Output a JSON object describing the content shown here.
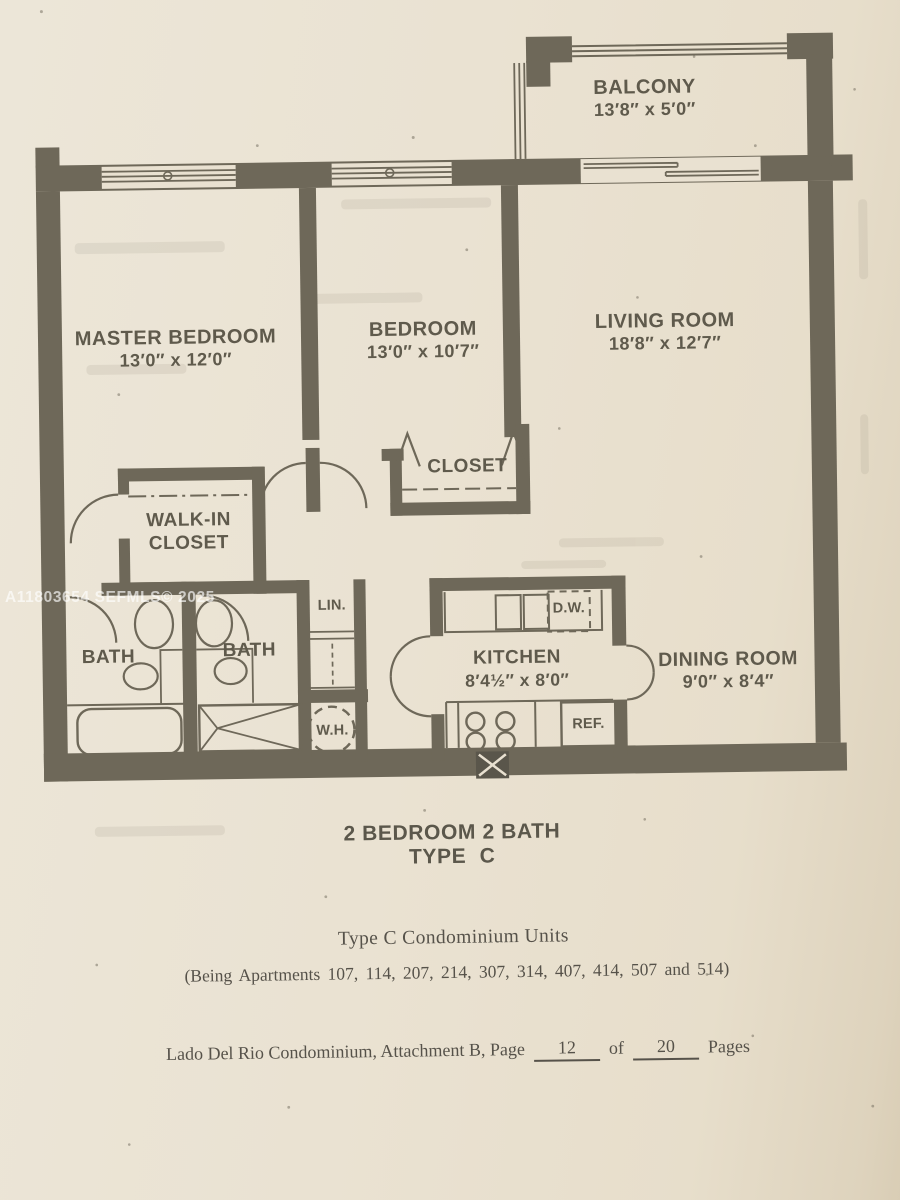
{
  "watermark": "A11803654  SEFMLS© 2025",
  "rooms": {
    "balcony": {
      "name": "BALCONY",
      "dims": "13′8″ x 5′0″"
    },
    "master_bedroom": {
      "name": "MASTER BEDROOM",
      "dims": "13′0″ x 12′0″"
    },
    "bedroom": {
      "name": "BEDROOM",
      "dims": "13′0″ x 10′7″"
    },
    "living_room": {
      "name": "LIVING ROOM",
      "dims": "18′8″ x 12′7″"
    },
    "dining_room": {
      "name": "DINING ROOM",
      "dims": "9′0″ x 8′4″"
    },
    "kitchen": {
      "name": "KITCHEN",
      "dims": "8′4½″ x 8′0″"
    },
    "closet": {
      "name": "CLOSET"
    },
    "walk_in_closet": {
      "line1": "WALK-IN",
      "line2": "CLOSET"
    },
    "bath": {
      "name": "BATH"
    }
  },
  "fixtures": {
    "linen_closet": "LIN.",
    "dishwasher": "D.W.",
    "refrigerator": "REF.",
    "water_heater": "W.H."
  },
  "captions": {
    "plan_title_line1": "2 BEDROOM 2 BATH",
    "plan_title_line2": "TYPE C",
    "units_title": "Type C Condominium Units",
    "apartments": "(Being Apartments 107, 114, 207, 214, 307, 314, 407, 414, 507 and 514)",
    "footer_prefix": "Lado Del Rio Condominium, Attachment B, Page",
    "footer_page": "12",
    "footer_of": "of",
    "footer_total": "20",
    "footer_suffix": "Pages"
  },
  "colors": {
    "wall": "#6e6859",
    "paper": "#e9e1d1",
    "text": "#5f5a4c"
  }
}
